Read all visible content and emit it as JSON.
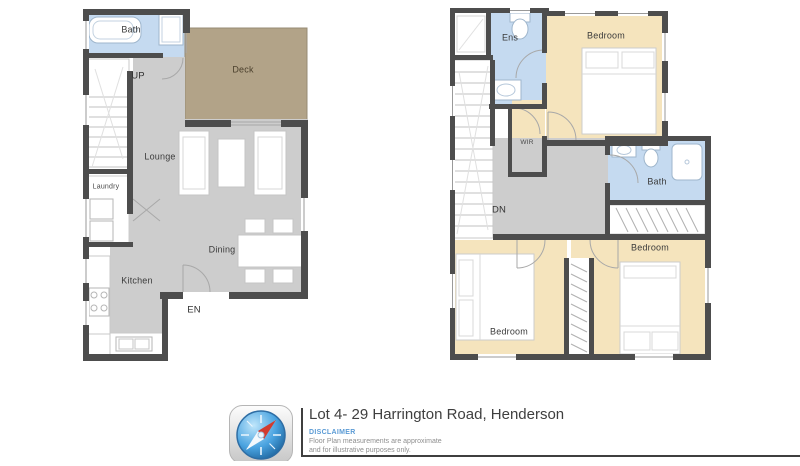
{
  "floor_plans": {
    "ground": {
      "rooms": {
        "bath": "Bath",
        "deck": "Deck",
        "lounge": "Lounge",
        "laundry": "Laundry",
        "dining": "Dining",
        "kitchen": "Kitchen"
      },
      "annotations": {
        "up": "UP",
        "entry": "EN"
      }
    },
    "upper": {
      "rooms": {
        "ens": "Ens",
        "bedroom_top": "Bedroom",
        "wir": "WIR",
        "bath": "Bath",
        "bedroom_left": "Bedroom",
        "bedroom_right": "Bedroom"
      },
      "annotations": {
        "down": "DN"
      }
    }
  },
  "footer": {
    "title": "Lot 4- 29 Harrington Road, Henderson",
    "disclaimer_label": "DISCLAIMER",
    "disclaimer_line1": "Floor Plan measurements are approximate",
    "disclaimer_line2": "and for illustrative purposes only.",
    "logo_icon": "compass-logo"
  },
  "colors": {
    "floor_gray": "#cdcdcd",
    "wall": "#4d4d4d",
    "wet_room_blue": "#c5daf0",
    "bedroom_tan": "#f5e4bd",
    "deck_brown": "#b2a388",
    "disclaimer_blue": "#5b9bd5",
    "footer_text": "#3f3f3f"
  }
}
